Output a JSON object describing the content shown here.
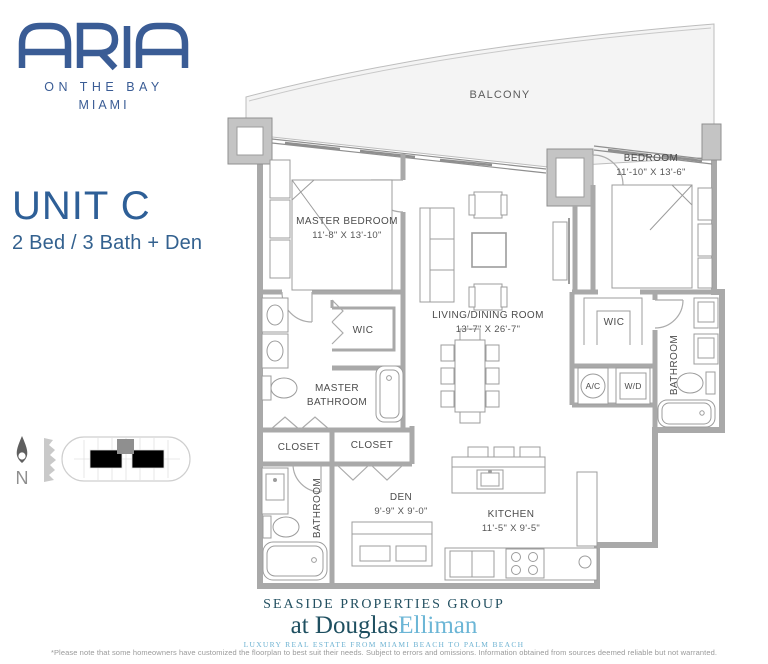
{
  "brand": {
    "name": "ARIA",
    "tagline": "ON THE BAY",
    "city": "MIAMI",
    "color": "#3a5c95"
  },
  "unit": {
    "title": "UNIT C",
    "subtitle": "2 Bed / 3 Bath + Den"
  },
  "floorplan": {
    "balcony": "BALCONY",
    "master_bedroom": {
      "name": "MASTER BEDROOM",
      "dims": "11'-8\" X 13'-10\""
    },
    "bedroom": {
      "name": "BEDROOM",
      "dims": "11'-10\" X 13'-6\""
    },
    "living": {
      "name": "LIVING/DINING ROOM",
      "dims": "13'-7\" X 26'-7\""
    },
    "den": {
      "name": "DEN",
      "dims": "9'-9\" X 9'-0\""
    },
    "kitchen": {
      "name": "KITCHEN",
      "dims": "11'-5\" X 9'-5\""
    },
    "wic": "WIC",
    "master_bath_line1": "MASTER",
    "master_bath_line2": "BATHROOM",
    "bathroom": "BATHROOM",
    "closet": "CLOSET",
    "ac": "A/C",
    "wd": "W/D"
  },
  "compass": {
    "north": "N"
  },
  "footer": {
    "group": "SEASIDE PROPERTIES GROUP",
    "at": "at ",
    "douglas": "Douglas",
    "elliman": "Elliman",
    "tagline": "LUXURY REAL ESTATE FROM MIAMI BEACH TO PALM BEACH",
    "disclaimer": "*Please note that some homeowners have customized the floorplan to best suit their needs. Subject to errors and omissions. Information obtained from sources deemed reliable but not warranted."
  },
  "colors": {
    "brand_blue": "#3a5c95",
    "dark_teal": "#1e4f60",
    "light_blue": "#6cb6d6",
    "wall_gray": "#a9a9a9",
    "balcony_fill": "#f4f4f4"
  }
}
